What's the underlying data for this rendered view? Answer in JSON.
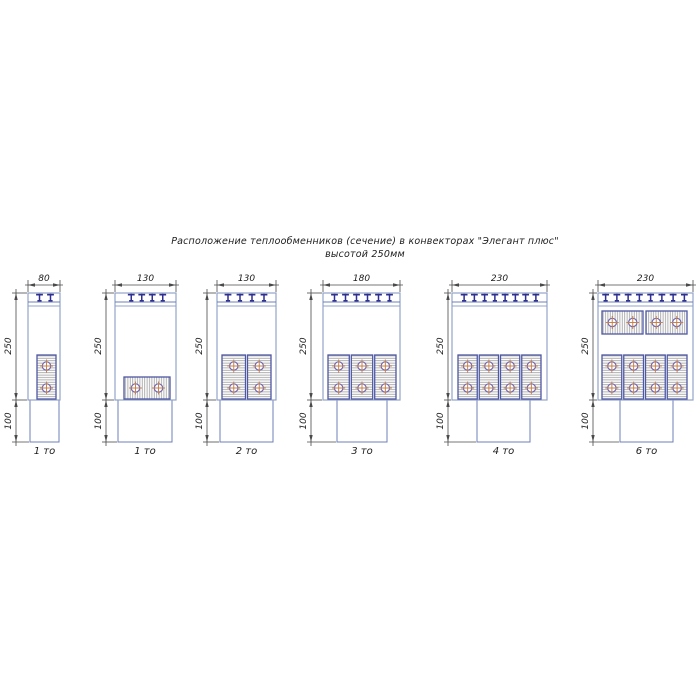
{
  "title": {
    "line1": "Расположение теплообменников (сечение) в конвекторах \"Элегант плюс\"",
    "line2": "высотой 250мм"
  },
  "dim_labels": {
    "upper_height": "250",
    "lower_height": "100"
  },
  "colors": {
    "box_outline": "#93a3c9",
    "box_outline_dark": "#6d7fba",
    "hx_border": "#4d58a3",
    "hatch_line": "#9c9c9c",
    "bracket": "#2f2f8f",
    "tube_ring": "#7466ad",
    "tube_cross": "#c8824a",
    "dim_line": "#4a4a4a",
    "text": "#1d1d1d"
  },
  "geometry": {
    "canvas_w": 700,
    "canvas_h": 700,
    "dim_top_line_y": 285,
    "dim_top_text_y": 281,
    "box_top": 293,
    "strip_lines": [
      302,
      306
    ],
    "box_bottom": 400,
    "duct_bottom": 442,
    "label_baseline_y": 454,
    "dim_upper_center_y": 346,
    "dim_lower_center_y": 421
  },
  "diagrams": [
    {
      "name": "80-1to",
      "width_label": "80",
      "count_label": "1 то",
      "box_x": [
        28,
        60
      ],
      "duct_x": [
        30,
        59
      ],
      "dim_x": 16,
      "bracket_count": 2,
      "bracket_span": [
        34,
        56
      ],
      "hx_units": [
        {
          "orientation": "vertical",
          "x": [
            37,
            56
          ],
          "y": [
            355,
            399
          ]
        }
      ]
    },
    {
      "name": "130-1to",
      "width_label": "130",
      "count_label": "1 то",
      "box_x": [
        115,
        176
      ],
      "duct_x": [
        118,
        172
      ],
      "dim_x": 106,
      "bracket_count": 4,
      "bracket_span": [
        126,
        168
      ],
      "hx_units": [
        {
          "orientation": "horizontal",
          "x": [
            124,
            170
          ],
          "y": [
            377,
            399
          ]
        }
      ]
    },
    {
      "name": "130-2to",
      "width_label": "130",
      "count_label": "2 то",
      "box_x": [
        217,
        276
      ],
      "duct_x": [
        220,
        273
      ],
      "dim_x": 207,
      "bracket_count": 4,
      "bracket_span": [
        222,
        270
      ],
      "hx_units": [
        {
          "orientation": "vertical",
          "x": [
            222,
            245.5
          ],
          "y": [
            355,
            399
          ]
        },
        {
          "orientation": "vertical",
          "x": [
            247.5,
            271
          ],
          "y": [
            355,
            399
          ]
        }
      ]
    },
    {
      "name": "180-3to",
      "width_label": "180",
      "count_label": "3 то",
      "box_x": [
        323,
        400
      ],
      "duct_x": [
        337,
        387
      ],
      "dim_x": 311,
      "bracket_count": 6,
      "bracket_span": [
        329,
        395
      ],
      "hx_units": [
        {
          "orientation": "vertical",
          "x": [
            328,
            349.3
          ],
          "y": [
            355,
            399
          ]
        },
        {
          "orientation": "vertical",
          "x": [
            351.3,
            372.7
          ],
          "y": [
            355,
            399
          ]
        },
        {
          "orientation": "vertical",
          "x": [
            374.7,
            396
          ],
          "y": [
            355,
            399
          ]
        }
      ]
    },
    {
      "name": "230-4to",
      "width_label": "230",
      "count_label": "4 то",
      "box_x": [
        452,
        547
      ],
      "duct_x": [
        477,
        530
      ],
      "dim_x": 448,
      "bracket_count": 8,
      "bracket_span": [
        459,
        541
      ],
      "hx_units": [
        {
          "orientation": "vertical",
          "x": [
            458,
            477.25
          ],
          "y": [
            355,
            399
          ]
        },
        {
          "orientation": "vertical",
          "x": [
            479.25,
            498.5
          ],
          "y": [
            355,
            399
          ]
        },
        {
          "orientation": "vertical",
          "x": [
            500.5,
            519.75
          ],
          "y": [
            355,
            399
          ]
        },
        {
          "orientation": "vertical",
          "x": [
            521.75,
            541
          ],
          "y": [
            355,
            399
          ]
        }
      ]
    },
    {
      "name": "230-6to",
      "width_label": "230",
      "count_label": "6 то",
      "box_x": [
        598,
        693
      ],
      "duct_x": [
        620,
        673
      ],
      "dim_x": 593,
      "bracket_count": 8,
      "bracket_span": [
        600,
        690
      ],
      "hx_units": [
        {
          "orientation": "horizontal",
          "x": [
            602,
            643
          ],
          "y": [
            311,
            334
          ]
        },
        {
          "orientation": "horizontal",
          "x": [
            646,
            687
          ],
          "y": [
            311,
            334
          ]
        },
        {
          "orientation": "vertical",
          "x": [
            602,
            621.75
          ],
          "y": [
            355,
            399
          ]
        },
        {
          "orientation": "vertical",
          "x": [
            623.75,
            643.5
          ],
          "y": [
            355,
            399
          ]
        },
        {
          "orientation": "vertical",
          "x": [
            645.5,
            665.25
          ],
          "y": [
            355,
            399
          ]
        },
        {
          "orientation": "vertical",
          "x": [
            667.25,
            687
          ],
          "y": [
            355,
            399
          ]
        }
      ]
    }
  ]
}
